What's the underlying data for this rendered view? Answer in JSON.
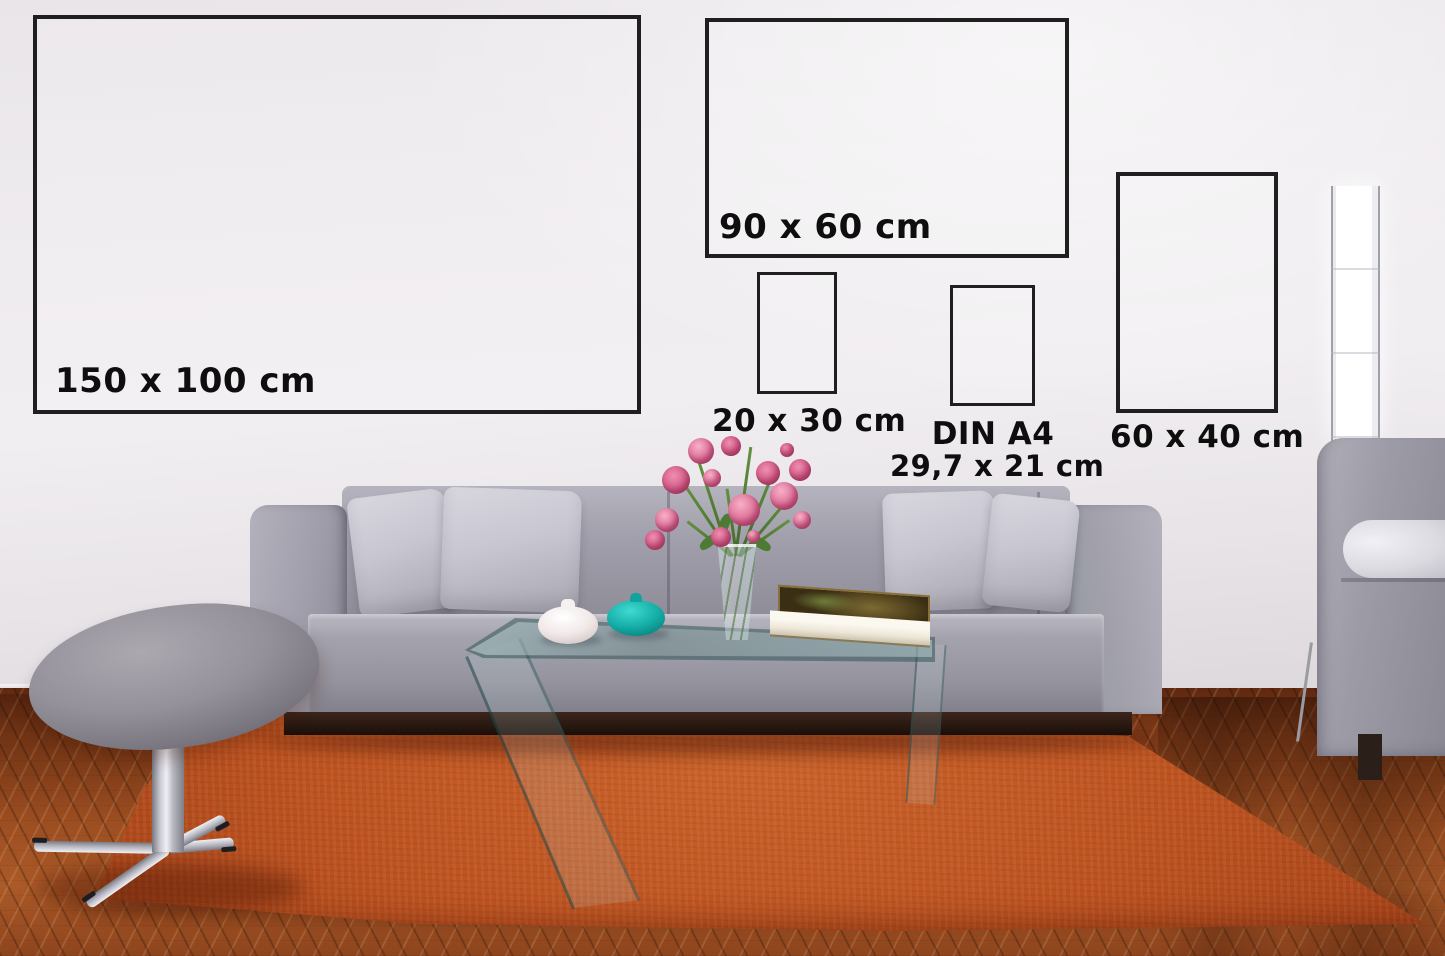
{
  "size_guide": {
    "frames": [
      {
        "id": "150x100",
        "label": "150 x 100 cm"
      },
      {
        "id": "90x60",
        "label": "90 x 60 cm"
      },
      {
        "id": "20x30",
        "label": "20 x 30 cm"
      },
      {
        "id": "din-a4",
        "label": "DIN A4",
        "sublabel": "29,7 x 21 cm"
      },
      {
        "id": "60x40",
        "label": "60 x 40 cm"
      }
    ],
    "frame_border_color": "#1f1f1f",
    "label_text_color": "#0e0e0e"
  },
  "scene": {
    "colors": {
      "wall": "#eeebee",
      "wood_floor": "#8a421d",
      "area_rug": "#b54f1f",
      "sofa_fabric": "#9b99a3",
      "pillow": "#c8c6d0",
      "sofa_plinth": "#2c1b13",
      "bolster_pillow": "#e6e5ec",
      "stool_fabric": "#8d8a93",
      "chrome": "#c9c9d2",
      "lamp_light": "#ffffff",
      "white_vase": "#f4eded",
      "teal_vase": "#17b0aa",
      "flower_pink": "#d5608b",
      "stem_green": "#4e7b33",
      "book_cover": "#574720",
      "glass_edge": "#2f5f5e"
    }
  }
}
